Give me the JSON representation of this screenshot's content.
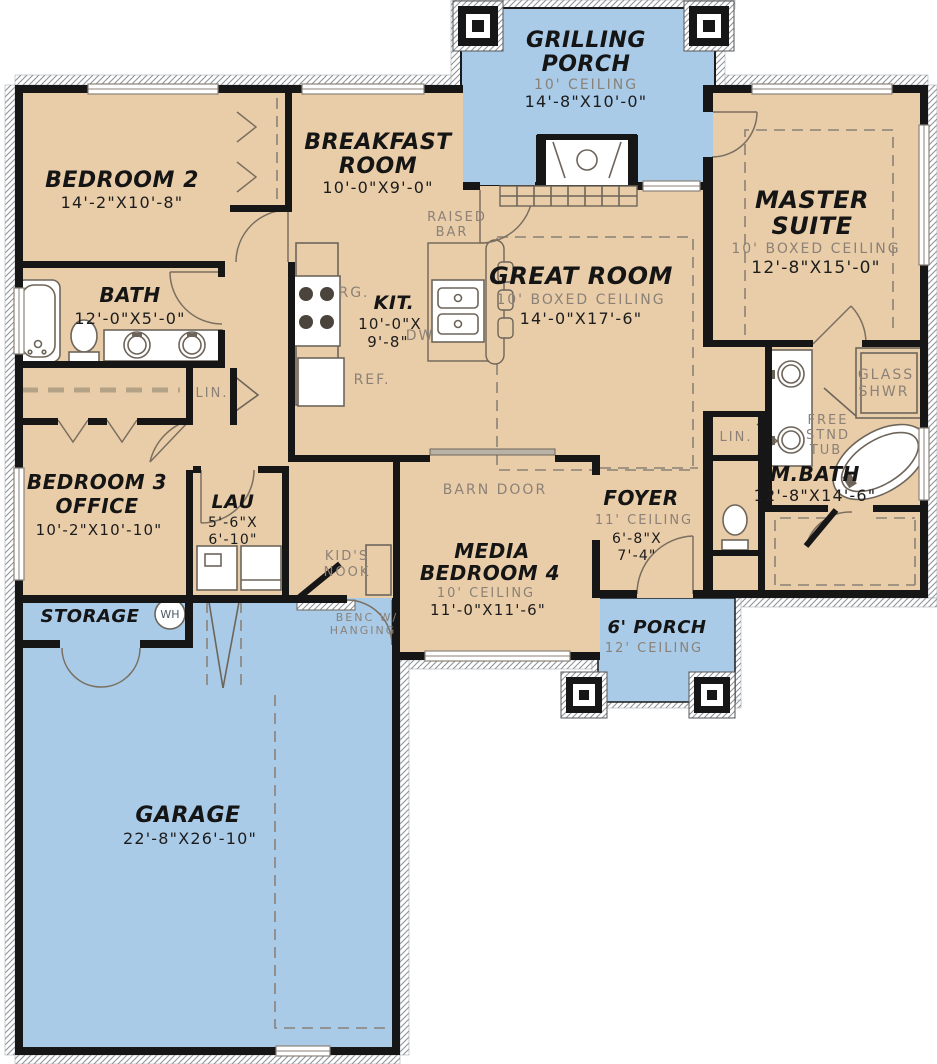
{
  "colors": {
    "interior": "#e9cda9",
    "porch_blue": "#a9cbe8",
    "wall": "#161616",
    "fixture_line": "#6e655a",
    "muted_text": "#8b8177",
    "ink": "#1c1c1c"
  },
  "rooms": {
    "grilling_porch": {
      "name1": "GRILLING",
      "name2": "PORCH",
      "ceiling": "10' CEILING",
      "dims": "14'-8\"X10'-0\""
    },
    "bedroom2": {
      "name": "BEDROOM 2",
      "dims": "14'-2\"X10'-8\""
    },
    "breakfast": {
      "name1": "BREAKFAST",
      "name2": "ROOM",
      "dims": "10'-0\"X9'-0\""
    },
    "master_suite": {
      "name1": "MASTER",
      "name2": "SUITE",
      "ceiling": "10' BOXED CEILING",
      "dims": "12'-8\"X15'-0\""
    },
    "bath": {
      "name": "BATH",
      "dims": "12'-0\"X5'-0\""
    },
    "kitchen": {
      "name": "KIT.",
      "dims1": "10'-0\"X",
      "dims2": "9'-8\""
    },
    "great_room": {
      "name": "GREAT ROOM",
      "ceiling": "10' BOXED CEILING",
      "dims": "14'-0\"X17'-6\""
    },
    "master_bath": {
      "name": "M.BATH",
      "dims": "12'-8\"X14'-6\""
    },
    "bedroom3": {
      "name1": "BEDROOM 3",
      "name2": "OFFICE",
      "dims": "10'-2\"X10'-10\""
    },
    "laundry": {
      "name": "LAU",
      "dims1": "5'-6\"X",
      "dims2": "6'-10\""
    },
    "media_bedroom": {
      "name1": "MEDIA",
      "name2": "BEDROOM 4",
      "ceiling": "10' CEILING",
      "dims": "11'-0\"X11'-6\""
    },
    "foyer": {
      "name": "FOYER",
      "ceiling": "11' CEILING",
      "dims1": "6'-8\"X",
      "dims2": "7'-4\""
    },
    "storage": {
      "name": "STORAGE"
    },
    "porch6": {
      "name": "6' PORCH",
      "ceiling": "12' CEILING"
    },
    "garage": {
      "name": "GARAGE",
      "dims": "22'-8\"X26'-10\""
    }
  },
  "labels": {
    "raised_bar1": "RAISED",
    "raised_bar2": "BAR",
    "range": "RG.",
    "dishwasher": "DW",
    "refrigerator": "REF.",
    "linen_hall": "LIN.",
    "linen_master": "LIN.",
    "glass_shower1": "GLASS",
    "glass_shower2": "SHWR",
    "tub1": "FREE",
    "tub2": "STND",
    "tub3": "TUB",
    "barn_door": "BARN DOOR",
    "kids_nook1": "KID'S",
    "kids_nook2": "NOOK",
    "bench1": "BENC W/",
    "bench2": "HANGING",
    "water_heater": "WH"
  }
}
